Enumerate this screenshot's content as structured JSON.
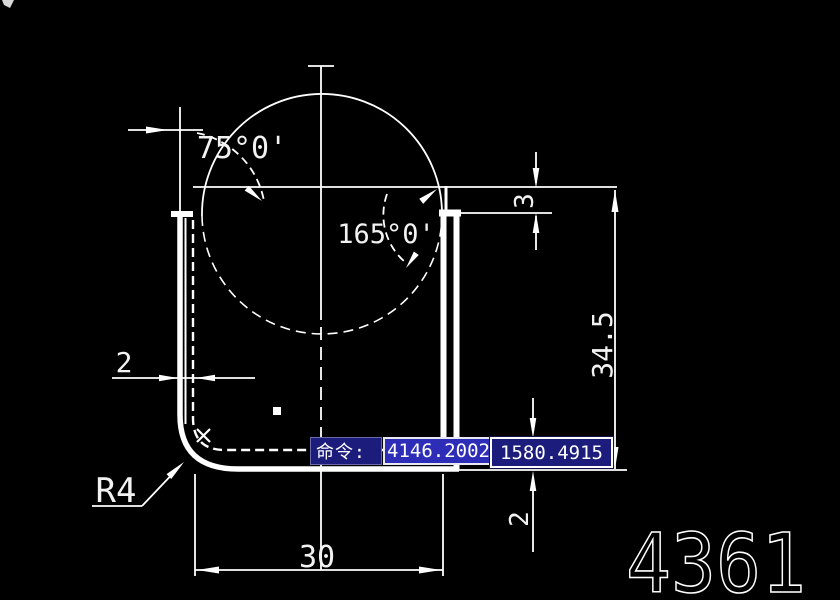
{
  "canvas": {
    "part_number": "4361",
    "dims": {
      "angle_left": "75°0'",
      "angle_right": "165°0'",
      "offset_top": "3",
      "height": "34.5",
      "thickness_left": "2",
      "thickness_bottom": "2",
      "width": "30",
      "corner_radius": "R4"
    }
  },
  "command_bar": {
    "prompt": "命令:",
    "coord_x": "4146.2002",
    "separator": "-",
    "coord_y": "1580.4915"
  },
  "colors": {
    "background": "#000000",
    "line": "#ffffff",
    "command_navy": "#1c1c7c",
    "selection_blue": "#2d2db8"
  }
}
